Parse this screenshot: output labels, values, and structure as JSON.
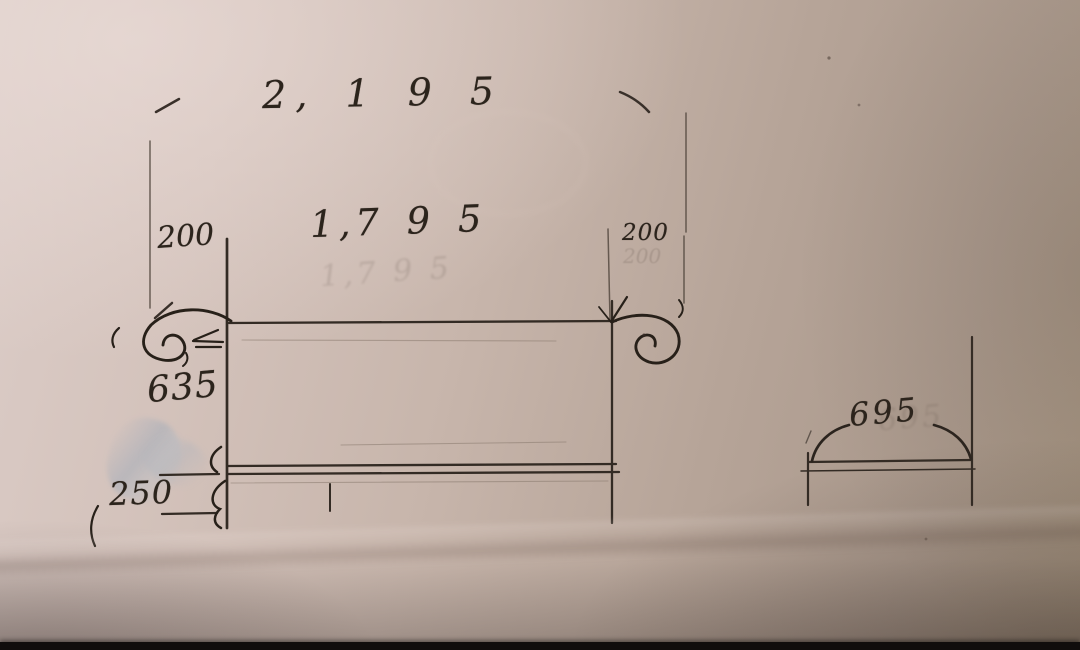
{
  "photo": {
    "description": "Photograph of a hand-drawn pencil sketch with dimension annotations on beige paper",
    "colors": {
      "paper": "#c9b7ad",
      "paper_light": "#dccdc8",
      "paper_dark": "#a4937f",
      "graphite": "#39302a",
      "ink_dark": "#272019",
      "smudge_blue": "#8ba4bc",
      "table_edge": "#100d0c"
    }
  },
  "sketch": {
    "front_view": {
      "overall_width": "2, 1 9 5",
      "inner_width": "1,7 9 5",
      "left_offset": "200",
      "right_offset": "200",
      "height": "635",
      "base_height": "250"
    },
    "side_view": {
      "depth": "695"
    },
    "ghosts": {
      "inner_width_echo": "1,7 9 5",
      "right_offset_echo": "200",
      "depth_echo": "695"
    }
  }
}
